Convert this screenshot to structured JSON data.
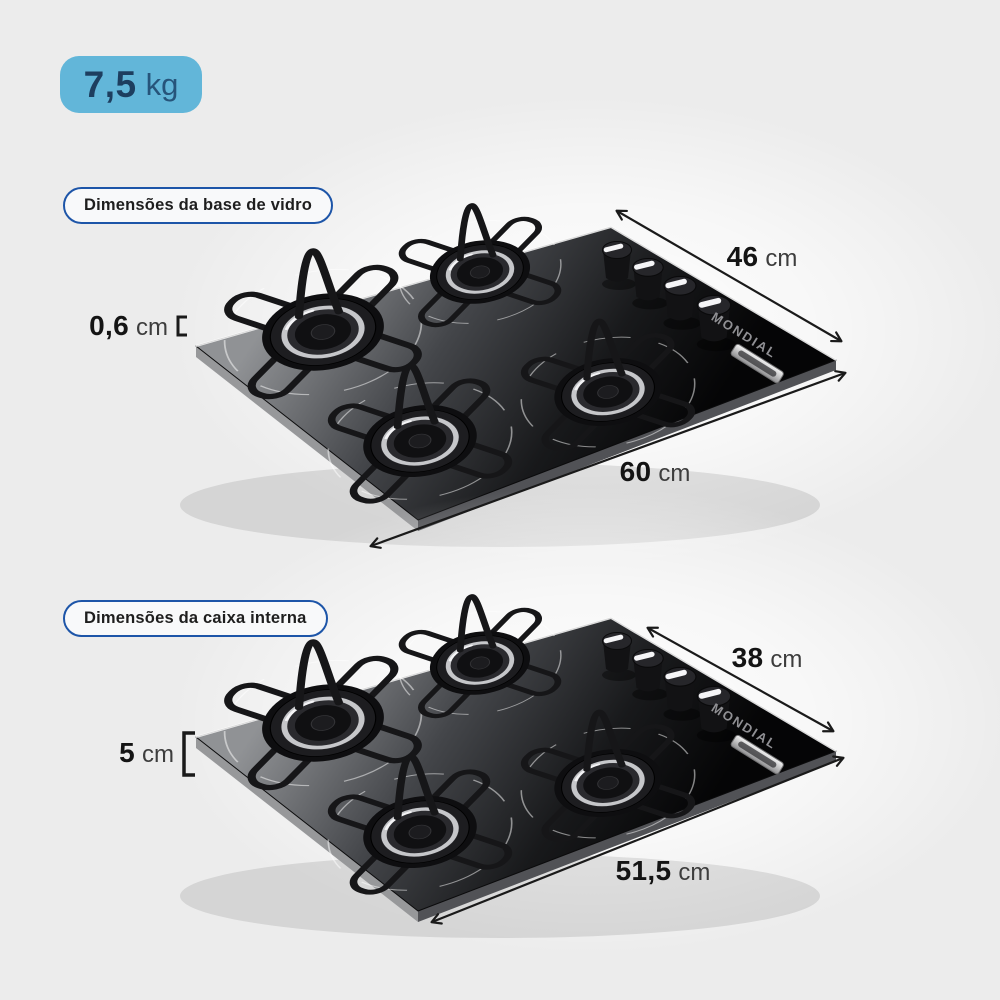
{
  "weight_badge": {
    "value": "7,5",
    "unit": "kg"
  },
  "brand": "MONDIAL",
  "sections": [
    {
      "label": "Dimensões da base de vidro",
      "depth": {
        "value": "46",
        "unit": "cm"
      },
      "width": {
        "value": "60",
        "unit": "cm"
      },
      "thickness": {
        "value": "0,6",
        "unit": "cm"
      }
    },
    {
      "label": "Dimensões da caixa interna",
      "depth": {
        "value": "38",
        "unit": "cm"
      },
      "width": {
        "value": "51,5",
        "unit": "cm"
      },
      "thickness": {
        "value": "5",
        "unit": "cm"
      }
    }
  ],
  "colors": {
    "background": "#ececec",
    "badge_bg": "#62b6d9",
    "badge_text": "#1d3e5f",
    "pill_border": "#1d55a8",
    "dimension_text": "#141414",
    "arrow": "#1a1a1a",
    "cooktop_glass": "#0a0a0c"
  }
}
